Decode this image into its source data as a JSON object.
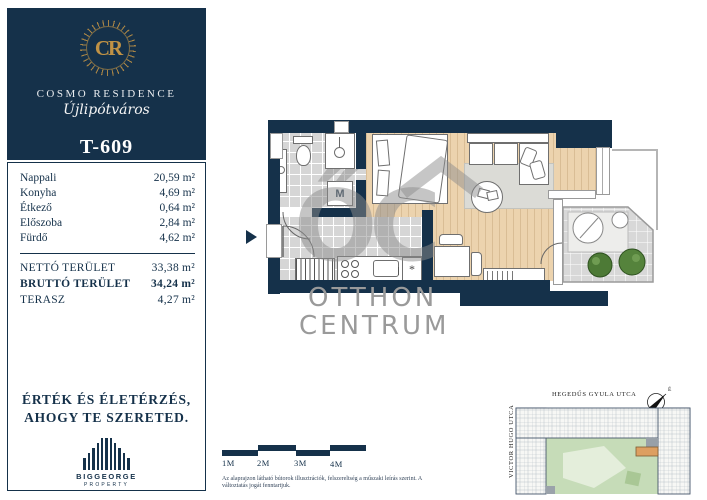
{
  "brand": {
    "monogram": "CR",
    "name": "COSMO RESIDENCE",
    "district": "Újlipótváros",
    "unit_id": "T-609"
  },
  "area_table": {
    "rooms": [
      {
        "label": "Nappali",
        "value": "20,59",
        "unit": "m²"
      },
      {
        "label": "Konyha",
        "value": "4,69",
        "unit": "m²"
      },
      {
        "label": "Étkező",
        "value": "0,64",
        "unit": "m²"
      },
      {
        "label": "Előszoba",
        "value": "2,84",
        "unit": "m²"
      },
      {
        "label": "Fürdő",
        "value": "4,62",
        "unit": "m²"
      }
    ],
    "totals": [
      {
        "label": "NETTÓ TERÜLET",
        "value": "33,38",
        "unit": "m²"
      },
      {
        "label": "BRUTTÓ TERÜLET",
        "value": "34,24",
        "unit": "m²"
      },
      {
        "label": "TERASZ",
        "value": "4,27",
        "unit": "m²"
      }
    ]
  },
  "tagline": {
    "line1": "ÉRTÉK ÉS ÉLETÉRZÉS,",
    "line2": "AHOGY TE SZERETED."
  },
  "developer": {
    "name": "BIGGEORGE",
    "subtitle": "PROPERTY"
  },
  "floorplan": {
    "washer_label": "M",
    "fridge_symbol": "*"
  },
  "watermark": {
    "monogram": "ŐC",
    "line1": "OTTHON",
    "line2": "CENTRUM"
  },
  "scale_bar": {
    "labels": [
      "1M",
      "2M",
      "3M",
      "4M"
    ]
  },
  "disclaimer": {
    "text": "Az alaprajzon látható bútorok illusztrációk, felszereltség a műszaki leírás szerint. A változtatás jogát fenntartjuk."
  },
  "site_plan": {
    "street_top": "HEGEDŰS GYULA UTCA",
    "street_left": "VICTOR HUGO UTCA",
    "street_right": "THURZÓ UTCA",
    "compass_label": "É"
  },
  "colors": {
    "navy": "#15314a",
    "gold": "#c09245",
    "wood": "#ecd3ae",
    "tile": "#d6d6d6",
    "courtyard_green": "#c6dcb8",
    "highlight_unit": "#dd9f61",
    "watermark_gray": "#9a9a9a"
  }
}
